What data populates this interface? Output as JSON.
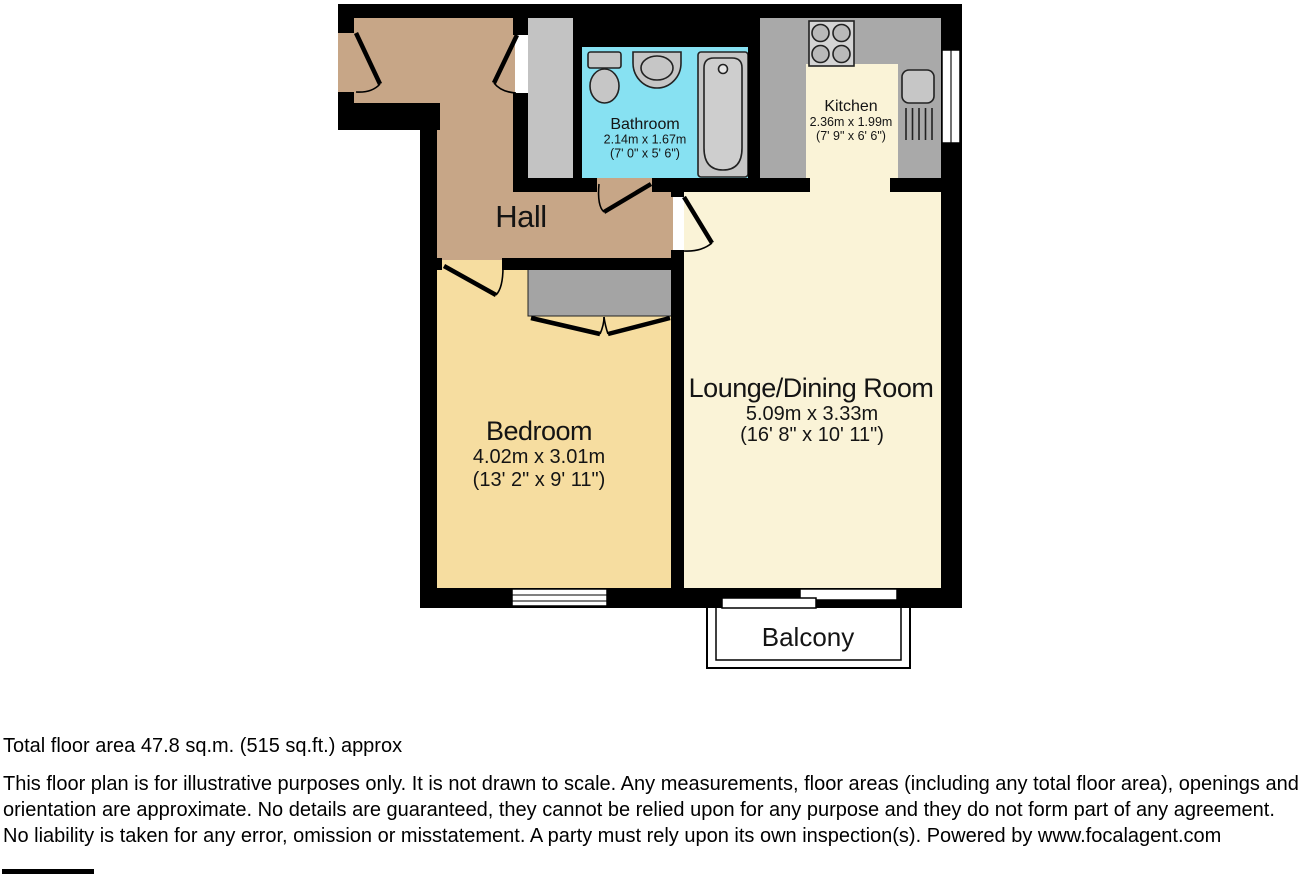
{
  "floor_plan": {
    "rooms": {
      "hall": {
        "name": "Hall"
      },
      "bathroom": {
        "name": "Bathroom",
        "metric": "2.14m x 1.67m",
        "imperial": "(7' 0\" x 5' 6\")"
      },
      "kitchen": {
        "name": "Kitchen",
        "metric": "2.36m x 1.99m",
        "imperial": "(7' 9\" x 6' 6\")"
      },
      "bedroom": {
        "name": "Bedroom",
        "metric": "4.02m x 3.01m",
        "imperial": "(13' 2\" x 9' 11\")"
      },
      "lounge_dining": {
        "name": "Lounge/Dining Room",
        "metric": "5.09m x 3.33m",
        "imperial": "(16' 8\" x 10' 11\")"
      },
      "balcony": {
        "name": "Balcony"
      }
    },
    "colors": {
      "wall": "#000000",
      "hall_floor": "#c7a687",
      "bedroom_floor": "#f6dda0",
      "living_floor": "#faf3d7",
      "bathroom_floor": "#87e1f2",
      "counter_gray": "#a9a9a9",
      "wardrobe_gray": "#a4a4a4",
      "cupboard_gray": "#c3c3c3",
      "fixture_gray": "#c6c6c6"
    },
    "icons": [
      "toilet-icon",
      "basin-icon",
      "bathtub-icon",
      "hob-icon",
      "kitchen-sink-icon",
      "wardrobe",
      "window",
      "sliding-door",
      "door-swing"
    ]
  },
  "footer": {
    "total_area": "Total floor area 47.8 sq.m. (515 sq.ft.) approx",
    "disclaimer": "This floor plan is for illustrative purposes only. It is not drawn to scale. Any measurements, floor areas (including any total floor area), openings and orientation are approximate. No details are guaranteed, they cannot be relied upon for any purpose and they do not form part of any agreement. No liability is taken for any error, omission or misstatement. A party must rely upon its own inspection(s). Powered by www.focalagent.com"
  }
}
